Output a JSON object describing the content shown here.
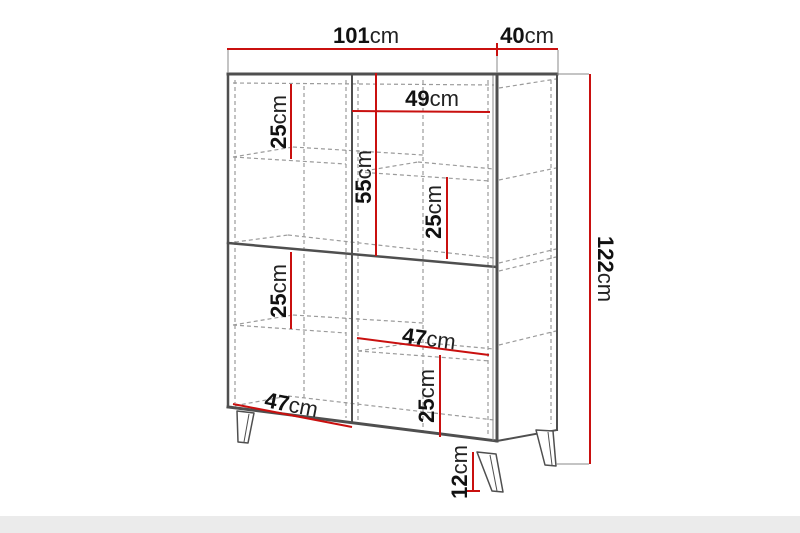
{
  "figure": {
    "subject": "highboard-cabinet-dimension-diagram",
    "units": "cm",
    "view": "perspective front-right with hidden shelf edges dashed"
  },
  "colors": {
    "dimension_red": "#c9100f",
    "outline_gray": "#4f4f4f",
    "hidden_gray": "#9b9b9b",
    "extension_gray": "#8a8a8a",
    "floor_band": "#ebebeb"
  },
  "dims": {
    "width_total": {
      "name": "overall width",
      "num": "101",
      "unit": "cm",
      "value": 101
    },
    "depth_total": {
      "name": "overall depth",
      "num": "40",
      "unit": "cm",
      "value": 40
    },
    "inner_width_upper_right": {
      "name": "upper right compartment width",
      "num": "49",
      "unit": "cm",
      "value": 49
    },
    "shelf_upper_left": {
      "name": "upper left shelf spacing",
      "num": "25",
      "unit": "cm",
      "value": 25
    },
    "upper_section_height": {
      "name": "upper section height",
      "num": "55",
      "unit": "cm",
      "value": 55
    },
    "shelf_upper_right": {
      "name": "upper right shelf spacing",
      "num": "25",
      "unit": "cm",
      "value": 25
    },
    "height_total": {
      "name": "overall height",
      "num": "122",
      "unit": "cm",
      "value": 122
    },
    "shelf_lower_left": {
      "name": "lower left shelf spacing",
      "num": "25",
      "unit": "cm",
      "value": 25
    },
    "inner_width_lower_right": {
      "name": "lower right compartment width",
      "num": "47",
      "unit": "cm",
      "value": 47
    },
    "shelf_lower_right": {
      "name": "lower right shelf spacing",
      "num": "25",
      "unit": "cm",
      "value": 25
    },
    "inner_width_lower_left": {
      "name": "lower left compartment width",
      "num": "47",
      "unit": "cm",
      "value": 47
    },
    "leg_height": {
      "name": "leg height",
      "num": "12",
      "unit": "cm",
      "value": 12
    }
  }
}
